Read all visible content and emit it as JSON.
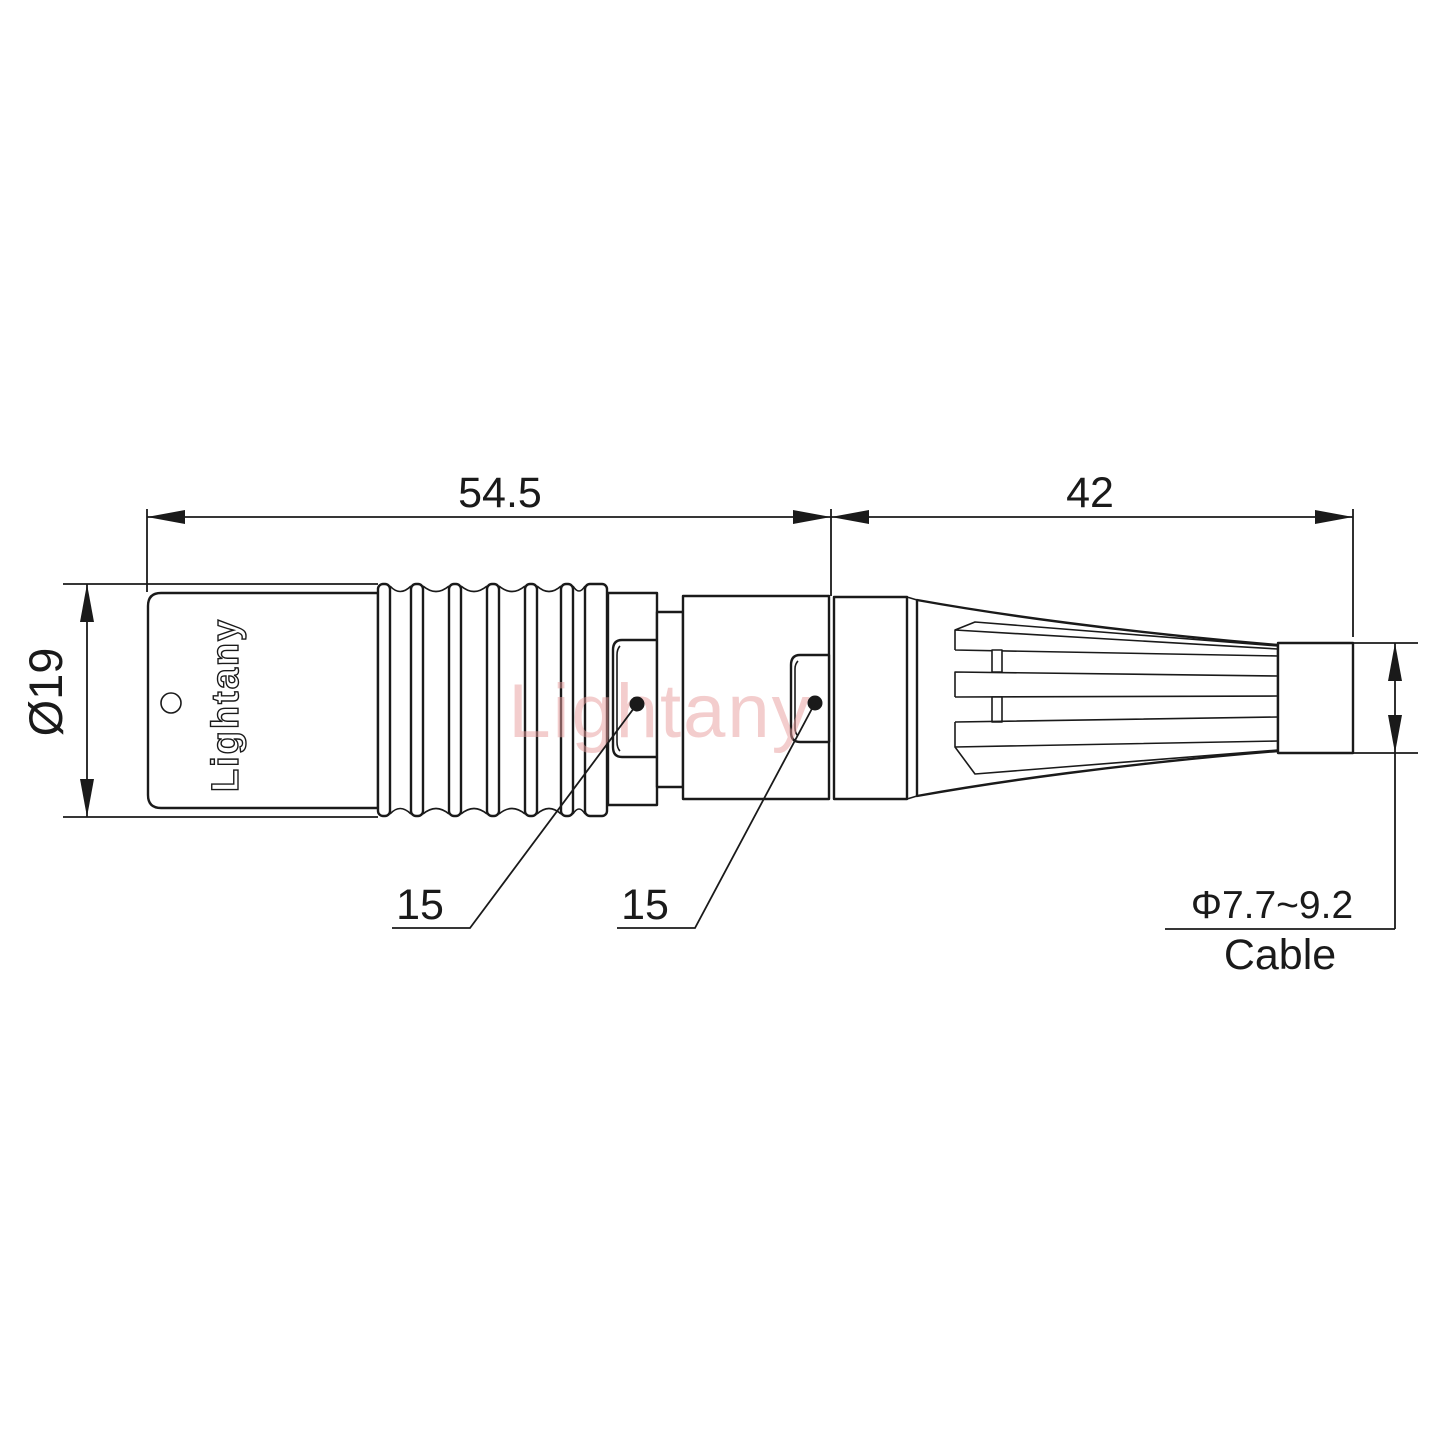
{
  "watermark": {
    "text": "Lightany"
  },
  "connector": {
    "brand_engraving": "Lightany"
  },
  "dimensions": {
    "front_length": "54.5",
    "boot_length": "42",
    "body_diameter": "Ø19",
    "collar_across_flats": "15",
    "coupling_across_flats": "15",
    "cable_diameter_range": "Φ7.7~9.2",
    "cable_caption": "Cable"
  },
  "colors": {
    "line": "#1a1a1a",
    "watermark": "#e89c9c",
    "background": "#ffffff"
  }
}
